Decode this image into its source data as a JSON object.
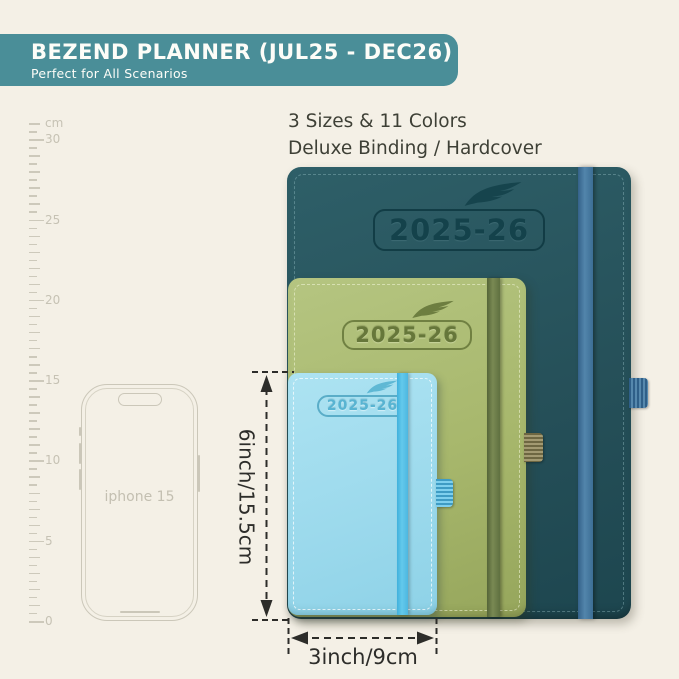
{
  "header": {
    "title": "BEZEND PLANNER (JUL25 - DEC26)",
    "subtitle": "Perfect for All Scenarios"
  },
  "info": {
    "line1": "3 Sizes & 11 Colors",
    "line2": "Deluxe Binding / Hardcover"
  },
  "ruler": {
    "unit": "cm",
    "labels": [
      "0",
      "5",
      "10",
      "15",
      "20",
      "25",
      "30"
    ]
  },
  "phone": {
    "label": "iphone 15"
  },
  "planners": [
    {
      "size": "large",
      "year": "2025-26",
      "cover_color": "#27535a",
      "band_color": "#4a7ba0",
      "emboss_color": "#14424b"
    },
    {
      "size": "medium",
      "year": "2025-26",
      "cover_color": "#a9b96e",
      "band_color": "#6b7747",
      "emboss_color": "#66773a"
    },
    {
      "size": "small",
      "year": "2025-26",
      "cover_color": "#a9e2f1",
      "band_color": "#5ec7ea",
      "emboss_color": "#58b4d2"
    }
  ],
  "dimensions": {
    "height_label": "6inch/15.5cm",
    "width_label": "3inch/9cm"
  },
  "colors": {
    "background": "#f4f0e6",
    "header_bg": "#4a8e98",
    "header_text": "#fdfdf8",
    "body_text": "#3e4036",
    "ruler_gray": "#c6c2b4",
    "dimension_ink": "#2d2d2a"
  }
}
